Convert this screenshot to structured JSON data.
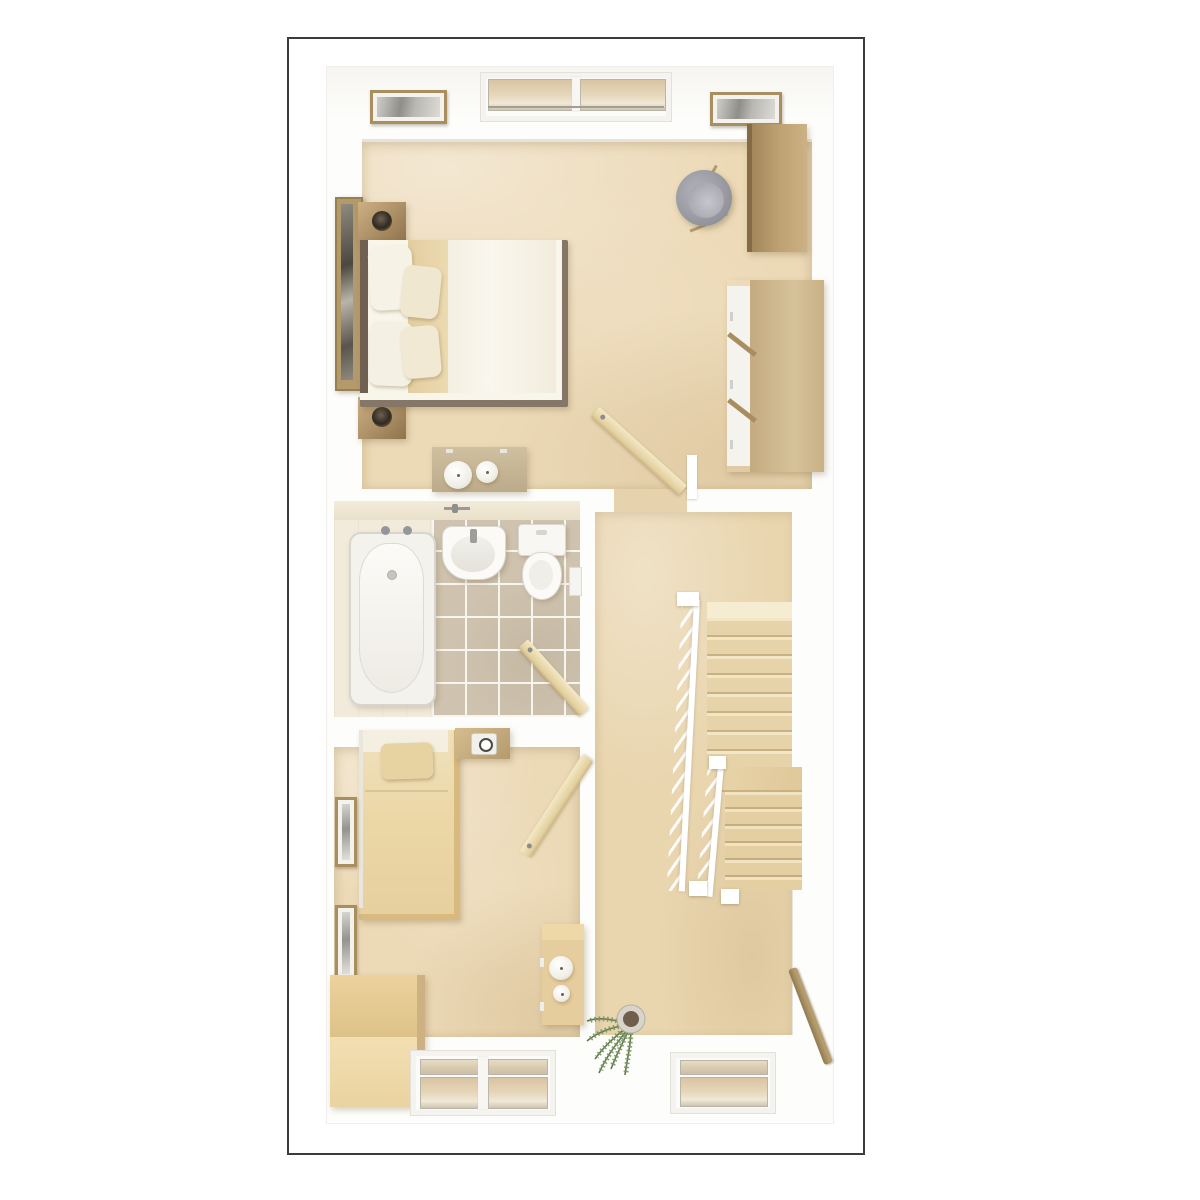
{
  "image_type": "3d-top-down-floorplan-render",
  "floor_label": "upper floor",
  "palette": {
    "page_background": "#ffffff",
    "border": "#3c3c3c",
    "walls": "#fdfdfb",
    "bedroom_floor": "#ecd9b6",
    "landing_carpet": "#e9d5ae",
    "bathroom_tile": "#cfc3af",
    "tile_grout": "#ffffff",
    "wood_furniture": "#b0935f",
    "light_wood_furniture": "#e6cd9d",
    "stair_tread": "#e7d3a9",
    "chair_gray": "#9a9aa2",
    "plant_green": "#7c9465",
    "linen_white": "#f8f5ea"
  },
  "rooms": [
    {
      "name": "Main Bedroom",
      "position": "top",
      "furniture": [
        "double bed with white duvet and four pillows",
        "bedside table with lamp (left)",
        "bedside table with lamp (right)",
        "tall leaning mirror",
        "desk",
        "grey tub chair",
        "wardrobe with white doors",
        "dressing table with pouf and roll",
        "open door"
      ],
      "windows": [
        "double window on top wall"
      ],
      "wall_art": [
        "framed picture left",
        "framed picture right"
      ]
    },
    {
      "name": "Bathroom",
      "position": "middle-left",
      "floor": "beige tiles with white grout",
      "furniture": [
        "bathtub with two taps",
        "wash basin",
        "toilet with cistern",
        "wall radiator",
        "open door"
      ]
    },
    {
      "name": "Bedroom 2",
      "position": "bottom-left",
      "furniture": [
        "single bed with beige duvet and pillow",
        "bedside table with clock",
        "storage bench",
        "side table with two candles",
        "open door"
      ],
      "windows": [
        "double window on bottom wall"
      ],
      "wall_art": [
        "framed picture upper",
        "framed picture lower"
      ]
    },
    {
      "name": "Landing",
      "position": "right",
      "furniture": [
        "staircase down",
        "white banister with balusters",
        "second banister",
        "wall-mounted wooden handrail",
        "potted plant"
      ],
      "windows": [
        "window on bottom wall"
      ]
    }
  ],
  "staircase": {
    "upper_flight_treads": 8,
    "winder": 1,
    "lower_flight_treads": 6,
    "banisters": 2
  },
  "doors_open_count": 3,
  "windows_total": 4
}
